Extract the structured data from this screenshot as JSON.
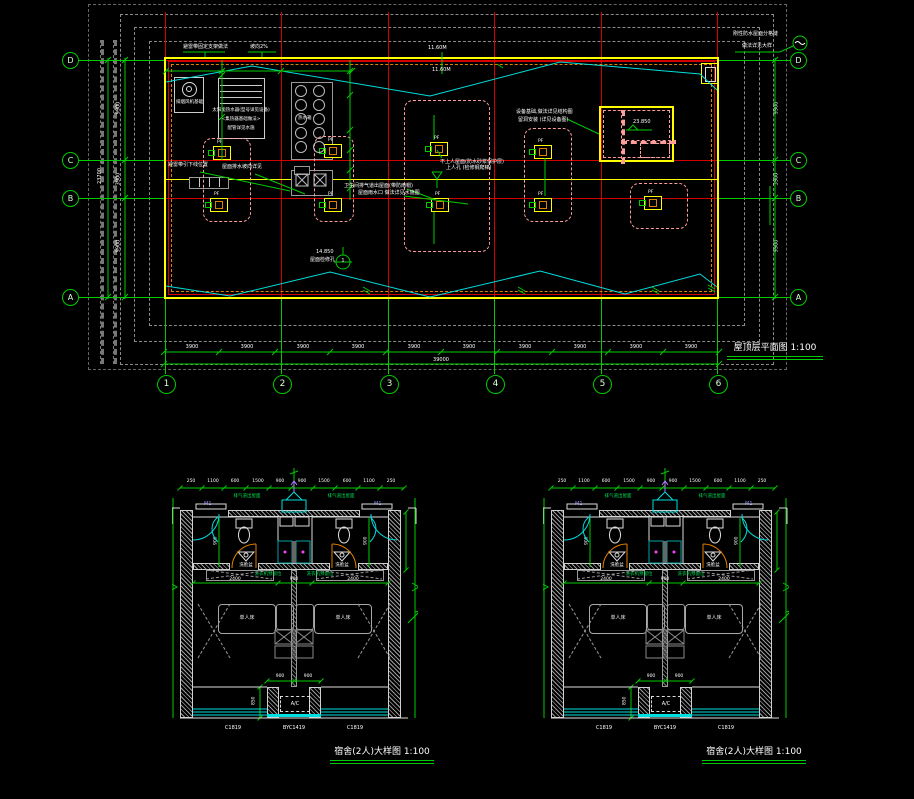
{
  "title_block": {
    "roof_title": "屋顶层平面图 1:100",
    "detail_title_left": "宿舍(2人)大样图 1:100",
    "detail_title_right": "宿舍(2人)大样图 1:100"
  },
  "roof_plan": {
    "grid_rows": [
      "D",
      "C",
      "B",
      "A"
    ],
    "grid_cols": [
      "1",
      "2",
      "3",
      "4",
      "5",
      "6"
    ],
    "fan_tag": "PF",
    "detail_no": "1",
    "dims": {
      "bottom": [
        "3900",
        "3900",
        "3900",
        "3900",
        "3900",
        "3900",
        "3900",
        "3900",
        "3900",
        "3900"
      ],
      "bottom_total": "39000",
      "left": [
        "9900",
        "3900",
        "9900"
      ],
      "left_total": "23700",
      "right": [
        "9900",
        "3900",
        "9900"
      ]
    },
    "annotations": {
      "belt_support": "避雷带固定支架做法",
      "slope1": "坡向2%",
      "joint1": "刚性防水屋面分格缝",
      "joint2": "做法详见大样",
      "downlead": "避雷带引下线位置",
      "drain_dir": "屋面排水坡向详见",
      "vent_note": "卫生间排气道出屋面(带防雨帽)",
      "rain_note": "屋面雨水口 做法详见水施图",
      "roof_note1": "不上人屋面(防水砂浆保护层)",
      "roof_note2": "上人孔 (检修钢爬梯)",
      "equip_note1": "设备基础,做法详见结构图",
      "equip_note2": "留洞安装 (详见设备图)",
      "access_note": "屋面检修孔",
      "fanroom": "排烟风机基础",
      "spec1": "太阳能热水器(型号详见设备)",
      "spec2": "<集热器基础做法>",
      "spec3": "配管详见水施",
      "tank_label": "热水箱",
      "level_penthouse": "23.850",
      "level_access": "14.850",
      "belt_h1": "11.60M",
      "belt_h2": "11.60M"
    }
  },
  "unit_detail": {
    "door_tag": "M1",
    "window_tags": [
      "C1819",
      "BYC1419",
      "C1819"
    ],
    "bed_label": "单人床",
    "basin_label": "洗脸盆",
    "washer_label": "洗衣机预留位",
    "ac_label": "A/C",
    "vent_label": "排气道出屋面",
    "dims_top": [
      "250",
      "1100",
      "600",
      "1500",
      "900",
      "900",
      "1500",
      "600",
      "1100",
      "250"
    ],
    "dims_mid": [
      "2400",
      "900",
      "2400"
    ],
    "dims_ac": [
      "900",
      "900"
    ],
    "dim_side": "850",
    "dim_bath": "900"
  },
  "colors": {
    "accent_green": "#00cc00",
    "grid_red": "#d40000",
    "outline_yellow": "#ffff00",
    "lightning_cyan": "#00dede",
    "zone_pink": "#ff9c9c",
    "door_orange": "#e08000"
  }
}
